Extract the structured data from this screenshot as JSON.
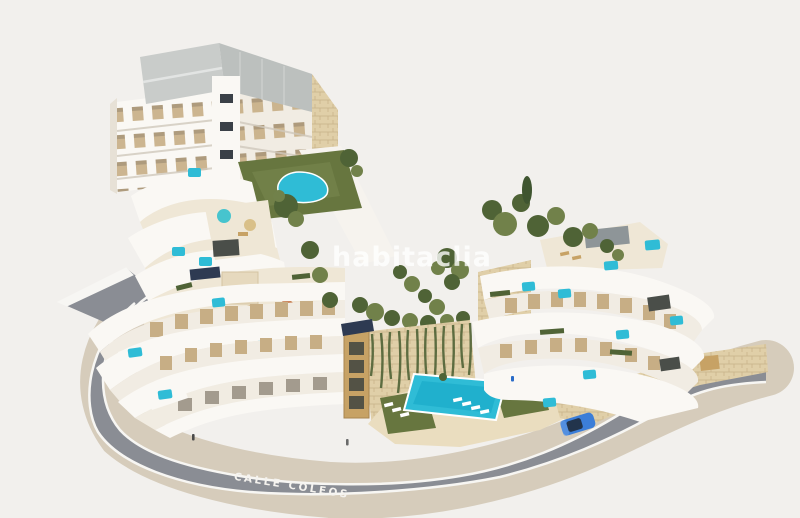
{
  "scene": {
    "type": "3D aerial architectural render",
    "subject": "Hillside residential complex of white curved terraced apartment buildings with private plunge pools, communal swimming pools, gardens, stone retaining walls and a perimeter street with a blue car"
  },
  "watermark": {
    "text": "habitaclia"
  },
  "road": {
    "label": "CALLE COLEOS"
  },
  "colors": {
    "bg": "#F2F0ED",
    "road": "#8A8D94",
    "roadLine": "#F7F6F3",
    "sidewalk": "#D6CCBB",
    "facade": "#FAF8F4",
    "facadeTint": "#F1ECE3",
    "windowTan": "#C7AE85",
    "windowDark": "#5C5548",
    "roof": "#C9CCCA",
    "roofDark": "#BCC0BE",
    "roofLight": "#E2E4E3",
    "stone": "#E0CFA8",
    "stoneLine": "#C7B188",
    "terrace": "#EFE7D6",
    "lawn": "#67763F",
    "lawnLight": "#7C8A52",
    "tree": "#4F6336",
    "treeLight": "#71814A",
    "pool": "#2FBCD6",
    "poolDeep": "#18A8C6",
    "wood": "#C7A265",
    "pergola": "#4A4E49",
    "umbrella": "#C2703F",
    "solar": "#2E3A52",
    "car": "#3C7ED8",
    "carGlass": "#1F2C3D",
    "watermark": "rgba(255,255,255,0.78)",
    "roadText": "#F5F3EF"
  }
}
